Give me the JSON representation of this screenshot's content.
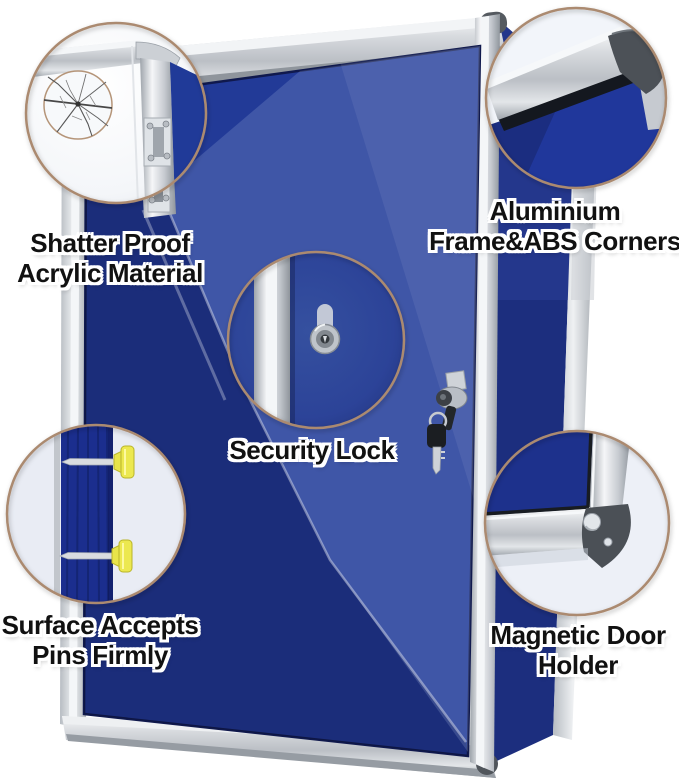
{
  "background_color": "#ffffff",
  "board": {
    "felt_color": "#223a97",
    "felt_highlight_color": "#4a63b8",
    "frame_silver_color": "#d9dcdf",
    "abs_corner_color": "#4d5257",
    "callout_ring_color": "#ab8a70",
    "pin_color": "#e8e44a",
    "key_color": "#1b1e22"
  },
  "callouts": [
    {
      "id": "shatterproof",
      "icon": "cracked-acrylic-icon",
      "line1": "Shatter Proof",
      "line2": "Acrylic Material"
    },
    {
      "id": "frame-corners",
      "icon": "aluminium-corner-icon",
      "line1": "Aluminium",
      "line2": "Frame&ABS Corners"
    },
    {
      "id": "security-lock",
      "icon": "lock-cylinder-icon",
      "line1": "Security Lock",
      "line2": ""
    },
    {
      "id": "pin-surface",
      "icon": "push-pins-icon",
      "line1": "Surface Accepts",
      "line2": "Pins Firmly"
    },
    {
      "id": "magnetic-holder",
      "icon": "magnet-corner-icon",
      "line1": "Magnetic Door",
      "line2": "Holder"
    }
  ]
}
